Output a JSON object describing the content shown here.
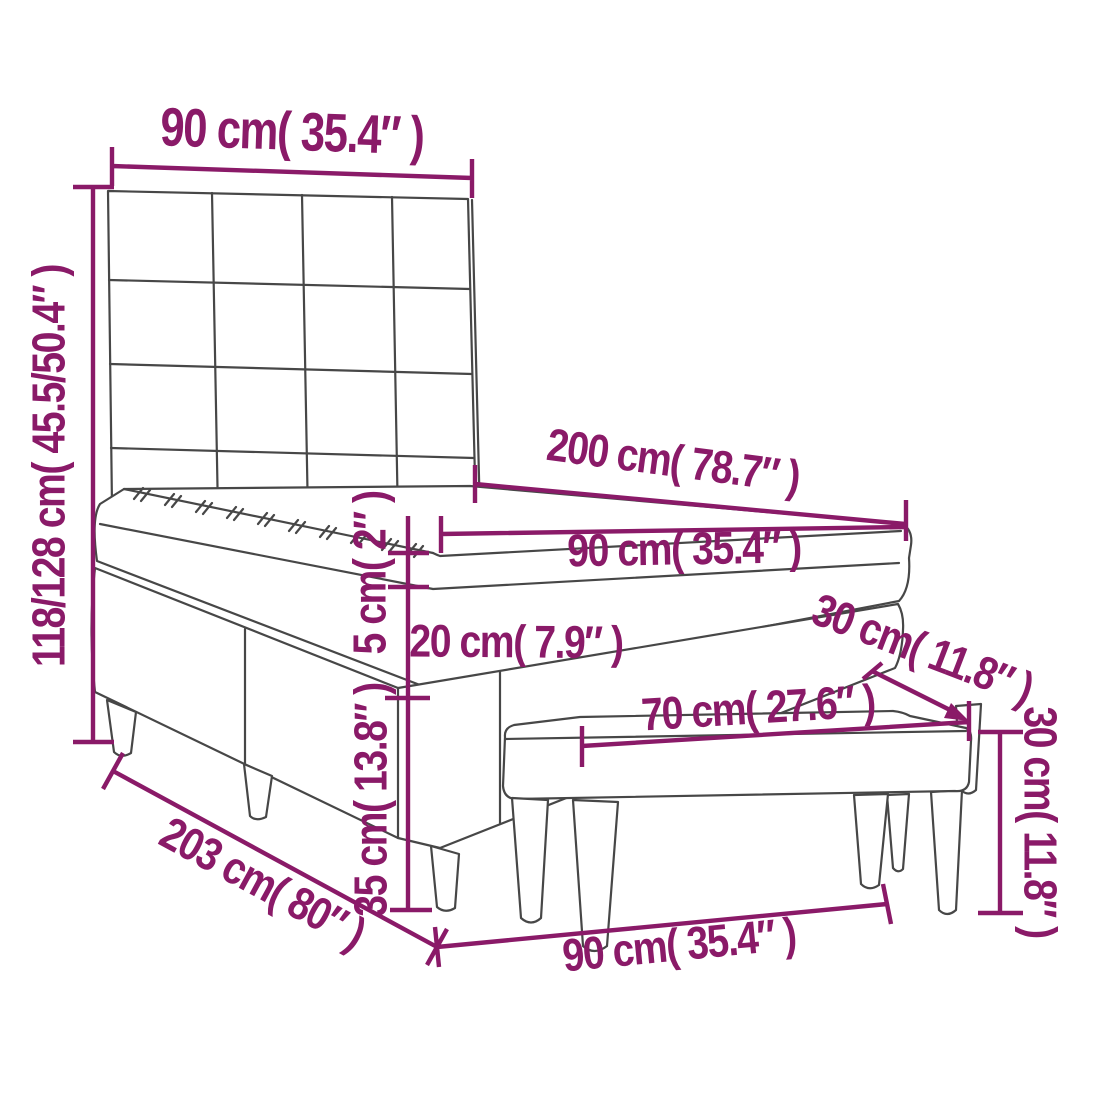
{
  "page": {
    "title": "Box spring bed with bench — dimension diagram"
  },
  "diagram": {
    "type": "furniture-dimension-diagram",
    "objects": [
      "box spring bed with tufted headboard, mattress and topper",
      "upholstered bench"
    ],
    "colors": {
      "dimension": "#8a1a68",
      "furniture_line": "#474747",
      "background": "#ffffff"
    },
    "dimensions": {
      "headboard_width": {
        "cm": "90",
        "in": "35.4",
        "text": "90 cm( 35.4″ )"
      },
      "overall_height": {
        "cm": "118/128",
        "in": "45.5/50.4",
        "text": "118/128 cm( 45.5/50.4″ )"
      },
      "bed_length": {
        "cm": "200",
        "in": "78.7",
        "text": "200 cm( 78.7″ )"
      },
      "mattress_width": {
        "cm": "90",
        "in": "35.4",
        "text": "90 cm( 35.4″ )"
      },
      "topper_height": {
        "cm": "5",
        "in": "2",
        "text": "5 cm( 2″ )"
      },
      "mattress_height": {
        "cm": "20",
        "in": "7.9",
        "text": "20 cm( 7.9″ )"
      },
      "base_height": {
        "cm": "35",
        "in": "13.8",
        "text": "35 cm( 13.8″ )"
      },
      "bench_length": {
        "cm": "70",
        "in": "27.6",
        "text": "70 cm( 27.6″ )"
      },
      "bench_depth": {
        "cm": "30",
        "in": "11.8",
        "text": "30 cm( 11.8″ )"
      },
      "bench_height": {
        "cm": "30",
        "in": "11.8",
        "text": "30 cm( 11.8″ )"
      },
      "total_length": {
        "cm": "203",
        "in": "80",
        "text": "203 cm( 80″ )"
      },
      "base_width": {
        "cm": "90",
        "in": "35.4",
        "text": "90 cm( 35.4″ )"
      }
    }
  }
}
